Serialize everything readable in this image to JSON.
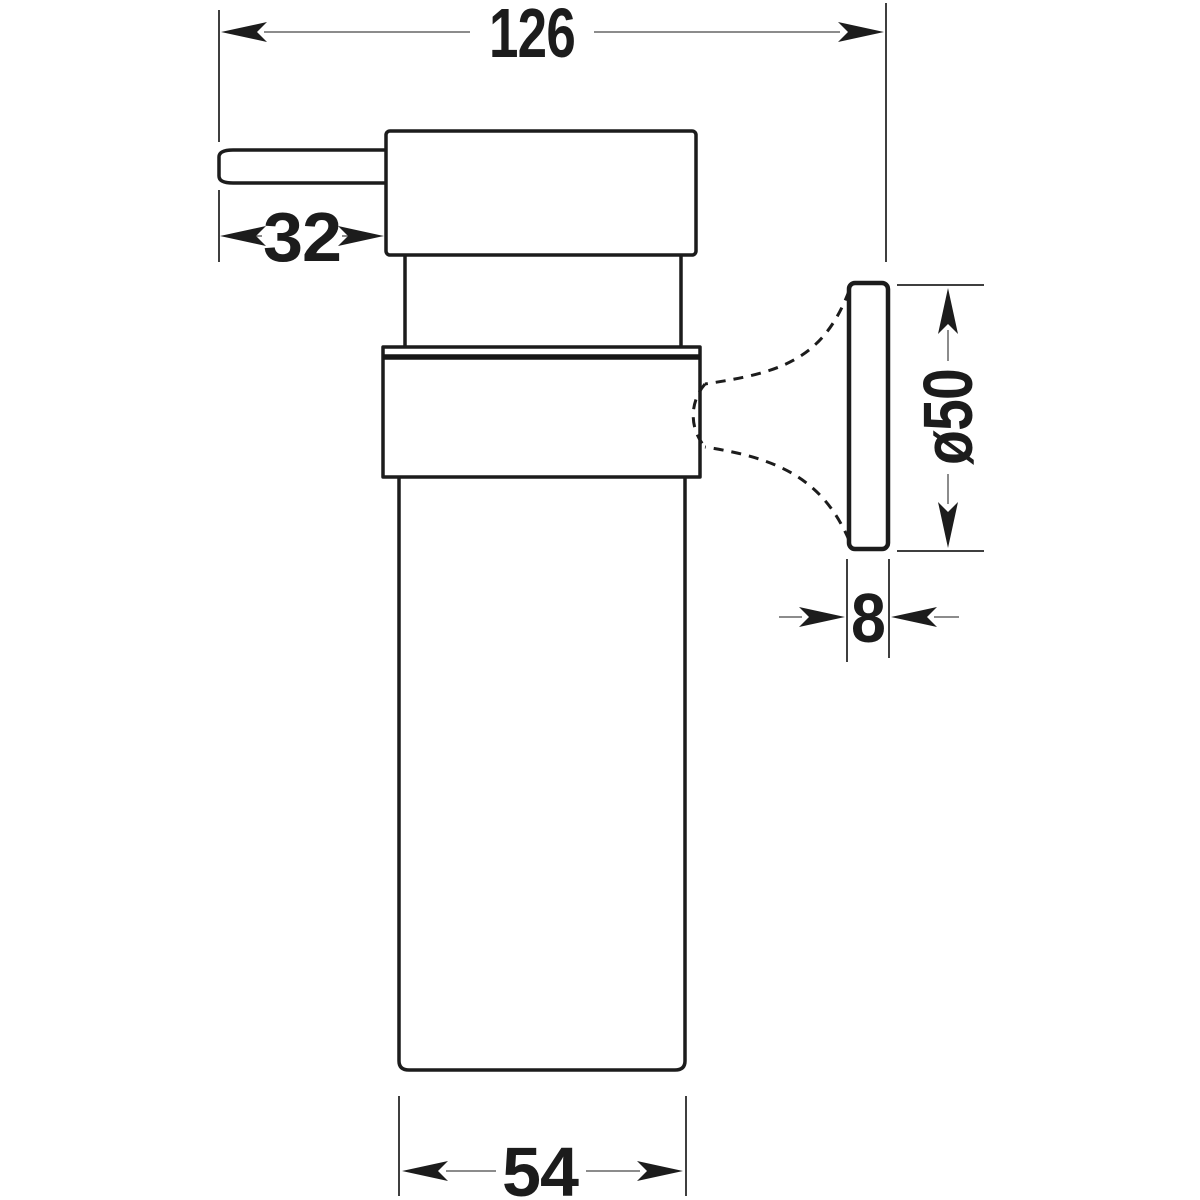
{
  "figure": {
    "type": "technical-dimension-drawing",
    "subject": "wall-mounted-soap-dispenser-side-view",
    "background_color": "#ffffff",
    "outline_color": "#1c1c1c",
    "dimension_line_color": "#8c8c8c"
  },
  "dimensions": {
    "overall_width": {
      "label": "126"
    },
    "spout_projection": {
      "label": "32"
    },
    "mounting_plate_diameter": {
      "label": "ø50"
    },
    "mounting_plate_thickness": {
      "label": "8"
    },
    "body_width": {
      "label": "54"
    }
  }
}
